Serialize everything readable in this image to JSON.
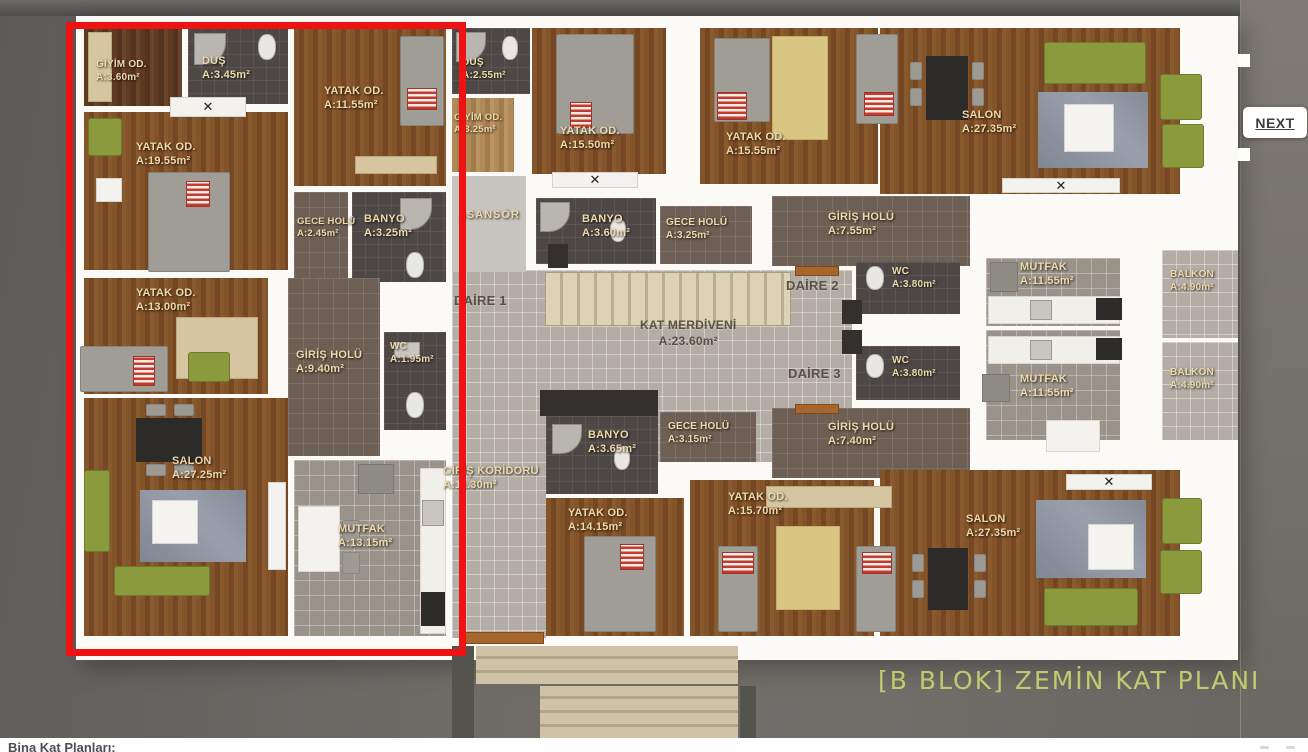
{
  "header": {
    "next_label": "NEXT"
  },
  "footer": {
    "label": "Bina Kat Planları:"
  },
  "caption": "[B BLOK] ZEMİN KAT PLANI",
  "colors": {
    "highlight": "#ee1212",
    "caption_text": "#c5d170",
    "wood_floor": "#7d4f28",
    "dark_tile": "#4d4846"
  },
  "common": {
    "asansor": "ASANSÖR",
    "daire1": "DAİRE 1",
    "daire2": "DAİRE 2",
    "daire3": "DAİRE 3",
    "kat_merdiveni": {
      "name": "KAT MERDİVENİ",
      "area": "A:23.60m²"
    },
    "giris_koridoru": {
      "name": "GİRİŞ KORİDORU",
      "area": "A:11.30m²"
    }
  },
  "rooms": [
    {
      "apartment": 1,
      "name": "GİYİM OD.",
      "area": "A:3.60m²"
    },
    {
      "apartment": 1,
      "name": "DUŞ",
      "area": "A:3.45m²"
    },
    {
      "apartment": 1,
      "name": "YATAK OD.",
      "area": "A:11.55m²"
    },
    {
      "apartment": 1,
      "name": "YATAK OD.",
      "area": "A:19.55m²"
    },
    {
      "apartment": 1,
      "name": "GECE HOLÜ",
      "area": "A:2.45m²"
    },
    {
      "apartment": 1,
      "name": "BANYO",
      "area": "A:3.25m²"
    },
    {
      "apartment": 1,
      "name": "YATAK OD.",
      "area": "A:13.00m²"
    },
    {
      "apartment": 1,
      "name": "GİRİŞ HOLÜ",
      "area": "A:9.40m²"
    },
    {
      "apartment": 1,
      "name": "WC",
      "area": "A:1.95m²"
    },
    {
      "apartment": 1,
      "name": "SALON",
      "area": "A:27.25m²"
    },
    {
      "apartment": 1,
      "name": "MUTFAK",
      "area": "A:13.15m²"
    },
    {
      "apartment": 2,
      "name": "DUŞ",
      "area": "A:2.55m²"
    },
    {
      "apartment": 2,
      "name": "GİYİM OD.",
      "area": "A:3.25m²"
    },
    {
      "apartment": 2,
      "name": "YATAK OD.",
      "area": "A:15.50m²"
    },
    {
      "apartment": 2,
      "name": "BANYO",
      "area": "A:3.60m²"
    },
    {
      "apartment": 2,
      "name": "GECE HOLÜ",
      "area": "A:3.25m²"
    },
    {
      "apartment": 2,
      "name": "YATAK OD.",
      "area": "A:15.55m²"
    },
    {
      "apartment": 2,
      "name": "SALON",
      "area": "A:27.35m²"
    },
    {
      "apartment": 2,
      "name": "GİRİŞ HOLÜ",
      "area": "A:7.55m²"
    },
    {
      "apartment": 2,
      "name": "WC",
      "area": "A:3.80m²"
    },
    {
      "apartment": 2,
      "name": "MUTFAK",
      "area": "A:11.55m²"
    },
    {
      "apartment": 2,
      "name": "BALKON",
      "area": "A:4.90m²"
    },
    {
      "apartment": 3,
      "name": "BANYO",
      "area": "A:3.65m²"
    },
    {
      "apartment": 3,
      "name": "GECE HOLÜ",
      "area": "A:3.15m²"
    },
    {
      "apartment": 3,
      "name": "GİRİŞ HOLÜ",
      "area": "A:7.40m²"
    },
    {
      "apartment": 3,
      "name": "WC",
      "area": "A:3.80m²"
    },
    {
      "apartment": 3,
      "name": "MUTFAK",
      "area": "A:11.55m²"
    },
    {
      "apartment": 3,
      "name": "BALKON",
      "area": "A:4.90m²"
    },
    {
      "apartment": 3,
      "name": "YATAK OD.",
      "area": "A:14.15m²"
    },
    {
      "apartment": 3,
      "name": "YATAK OD.",
      "area": "A:15.70m²"
    },
    {
      "apartment": 3,
      "name": "SALON",
      "area": "A:27.35m²"
    }
  ]
}
